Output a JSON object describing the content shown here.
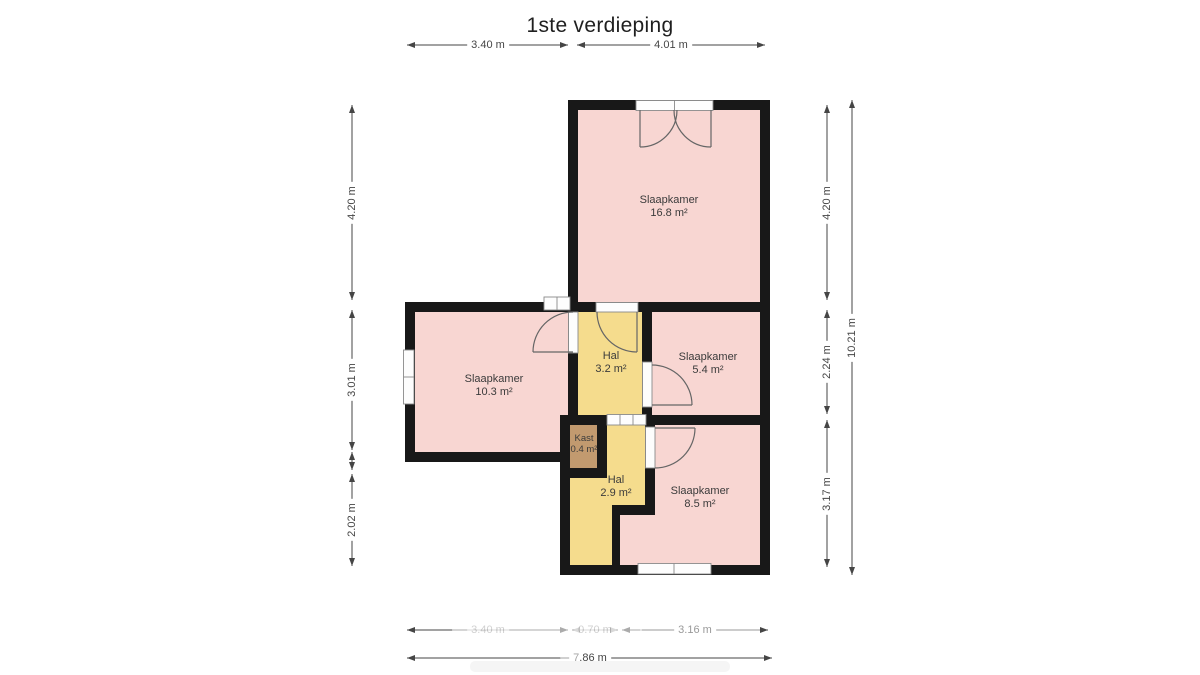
{
  "title": "1ste verdieping",
  "colors": {
    "room_pink": "#f8d6d2",
    "hall_yellow": "#f5dc8d",
    "closet_brown": "#c29a6f",
    "wall_black": "#181818",
    "dimension_gray": "#454545"
  },
  "rooms": [
    {
      "name": "Slaapkamer",
      "area": "16.8 m²"
    },
    {
      "name": "Slaapkamer",
      "area": "10.3 m²"
    },
    {
      "name": "Hal",
      "area": "3.2 m²"
    },
    {
      "name": "Slaapkamer",
      "area": "5.4 m²"
    },
    {
      "name": "Kast",
      "area": "0.4 m²"
    },
    {
      "name": "Hal",
      "area": "2.9 m²"
    },
    {
      "name": "Slaapkamer",
      "area": "8.5 m²"
    }
  ],
  "dimensions": {
    "top": [
      "3.40 m",
      "4.01 m"
    ],
    "left": [
      "4.20 m",
      "3.01 m",
      "2.02 m"
    ],
    "right": [
      "4.20 m",
      "2.24 m",
      "3.17 m"
    ],
    "right_total": "10.21 m",
    "bottom": [
      "3.40 m",
      "0.70 m",
      "3.16 m"
    ],
    "bottom_total": "7.86 m"
  }
}
